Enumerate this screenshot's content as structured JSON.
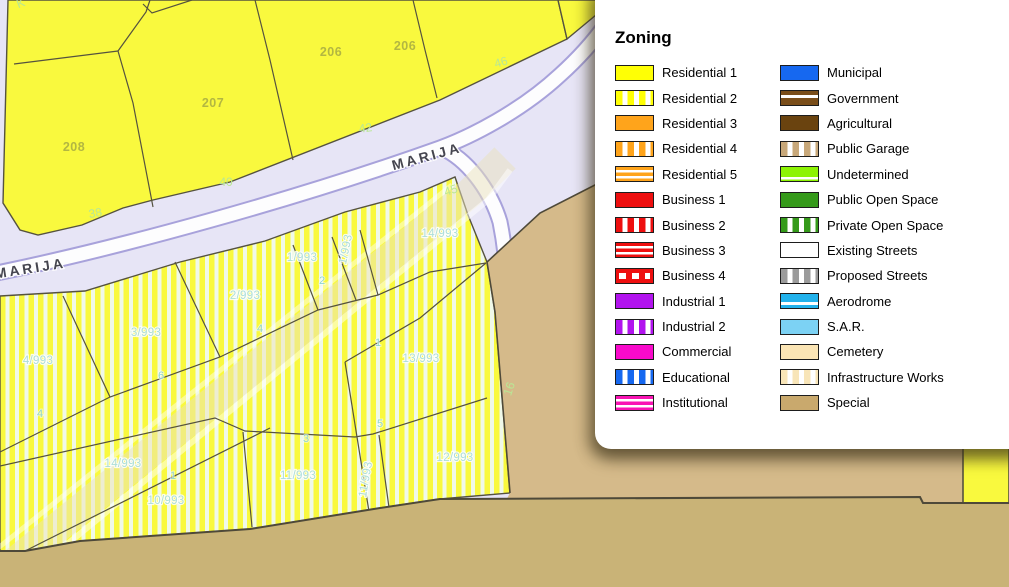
{
  "legend": {
    "title": "Zoning",
    "columns": [
      [
        {
          "label": "Residential 1",
          "color": "#FFFF05",
          "pattern": "solid"
        },
        {
          "label": "Residential 2",
          "color": "#FFFF05",
          "pattern": "vstripe"
        },
        {
          "label": "Residential 3",
          "color": "#FFA41B",
          "pattern": "solid"
        },
        {
          "label": "Residential 4",
          "color": "#FFA41B",
          "pattern": "vstripe"
        },
        {
          "label": "Residential 5",
          "color": "#FFA41B",
          "pattern": "hlines"
        },
        {
          "label": "Business 1",
          "color": "#EE0F0F",
          "pattern": "solid"
        },
        {
          "label": "Business 2",
          "color": "#EE0F0F",
          "pattern": "vstripe"
        },
        {
          "label": "Business 3",
          "color": "#EE0F0F",
          "pattern": "hlines"
        },
        {
          "label": "Business 4",
          "color": "#EE0F0F",
          "pattern": "hdash"
        },
        {
          "label": "Industrial 1",
          "color": "#B214EE",
          "pattern": "solid"
        },
        {
          "label": "Industrial 2",
          "color": "#B214EE",
          "pattern": "vstripe"
        },
        {
          "label": "Commercial",
          "color": "#F90ACB",
          "pattern": "solid"
        },
        {
          "label": "Educational",
          "color": "#1668F0",
          "pattern": "vstripe"
        },
        {
          "label": "Institutional",
          "color": "#F914B4",
          "pattern": "hlines"
        }
      ],
      [
        {
          "label": "Municipal",
          "color": "#1668F0",
          "pattern": "solid"
        },
        {
          "label": "Government",
          "color": "#7A4E1A",
          "pattern": "hline30"
        },
        {
          "label": "Agricultural",
          "color": "#6A430F",
          "pattern": "solid"
        },
        {
          "label": "Public Garage",
          "color": "#C8A87A",
          "pattern": "vstripe"
        },
        {
          "label": "Undetermined",
          "color": "#8DF303",
          "pattern": "hline75"
        },
        {
          "label": "Public Open Space",
          "color": "#359A1A",
          "pattern": "solid"
        },
        {
          "label": "Private Open Space",
          "color": "#359A1A",
          "pattern": "vstripe"
        },
        {
          "label": "Existing Streets",
          "color": "#FFFFFF",
          "pattern": "solid"
        },
        {
          "label": "Proposed Streets",
          "color": "#9B9B9B",
          "pattern": "vstripe"
        },
        {
          "label": "Aerodrome",
          "color": "#22B2EC",
          "pattern": "hline60"
        },
        {
          "label": "S.A.R.",
          "color": "#7CD2F4",
          "pattern": "solid"
        },
        {
          "label": "Cemetery",
          "color": "#FBE5B5",
          "pattern": "solid"
        },
        {
          "label": "Infrastructure Works",
          "color": "#F8E5B8",
          "pattern": "vstripe"
        },
        {
          "label": "Special",
          "color": "#C9A96D",
          "pattern": "solid"
        }
      ]
    ]
  },
  "map": {
    "colors": {
      "corridor": "#E7E5F6",
      "parcel_yellow": "#F9F93E",
      "stripe_white": "#F0F9E9",
      "road_fill": "#FDFDFE",
      "road_casing": "#A8A2DB",
      "boundary": "#55523F",
      "tan_light": "#D5BA8A",
      "tan_dark": "#C9B377",
      "tan_line": "#4E4939",
      "label_olive": "#A9AD42",
      "label_green": "#B9E795",
      "label_cyan": "#ACDED9",
      "label_cyan_small": "#8FD5CE",
      "street_label": "#45454F"
    },
    "street_name_labels": [
      {
        "text": "MARIJA",
        "x": 428,
        "y": 161,
        "rot": -15
      },
      {
        "text": "MARIJA",
        "x": 31,
        "y": 273,
        "rot": -9
      }
    ],
    "block_labels": [
      {
        "text": "208",
        "x": 74,
        "y": 151
      },
      {
        "text": "207",
        "x": 213,
        "y": 107
      },
      {
        "text": "206",
        "x": 331,
        "y": 56
      },
      {
        "text": "206",
        "x": 405,
        "y": 50
      }
    ],
    "address_labels": [
      {
        "text": "38",
        "x": 96,
        "y": 217,
        "rot": -10
      },
      {
        "text": "40",
        "x": 226,
        "y": 186,
        "rot": 0
      },
      {
        "text": "42",
        "x": 366,
        "y": 132,
        "rot": -8
      },
      {
        "text": "45",
        "x": 452,
        "y": 194,
        "rot": -18
      },
      {
        "text": "46",
        "x": 502,
        "y": 66,
        "rot": -16
      },
      {
        "text": "16",
        "x": 513,
        "y": 390,
        "rot": -72
      },
      {
        "text": "K",
        "x": 22,
        "y": 7,
        "rot": -20
      }
    ],
    "parcel_labels": [
      {
        "text": "2/993",
        "x": 245,
        "y": 299,
        "rot": 0
      },
      {
        "text": "1/993",
        "x": 302,
        "y": 261,
        "rot": 0
      },
      {
        "text": "1/993",
        "x": 349,
        "y": 250,
        "rot": -78
      },
      {
        "text": "14/993",
        "x": 440,
        "y": 237,
        "rot": 0
      },
      {
        "text": "3/993",
        "x": 146,
        "y": 336,
        "rot": 0
      },
      {
        "text": "4/993",
        "x": 38,
        "y": 364,
        "rot": 0
      },
      {
        "text": "13/993",
        "x": 421,
        "y": 362,
        "rot": 0
      },
      {
        "text": "14/993",
        "x": 123,
        "y": 467,
        "rot": 0
      },
      {
        "text": "10/993",
        "x": 166,
        "y": 504,
        "rot": 0
      },
      {
        "text": "11/993",
        "x": 298,
        "y": 479,
        "rot": 0
      },
      {
        "text": "11/993",
        "x": 369,
        "y": 480,
        "rot": -80
      },
      {
        "text": "12/993",
        "x": 455,
        "y": 461,
        "rot": 0
      }
    ],
    "lot_labels": [
      {
        "text": "2",
        "x": 322,
        "y": 284
      },
      {
        "text": "4",
        "x": 260,
        "y": 332
      },
      {
        "text": "6",
        "x": 161,
        "y": 379
      },
      {
        "text": "4",
        "x": 40,
        "y": 417
      },
      {
        "text": "1",
        "x": 173,
        "y": 479
      },
      {
        "text": "3",
        "x": 306,
        "y": 442
      },
      {
        "text": "5",
        "x": 380,
        "y": 427
      },
      {
        "text": "1",
        "x": 378,
        "y": 346
      }
    ]
  }
}
